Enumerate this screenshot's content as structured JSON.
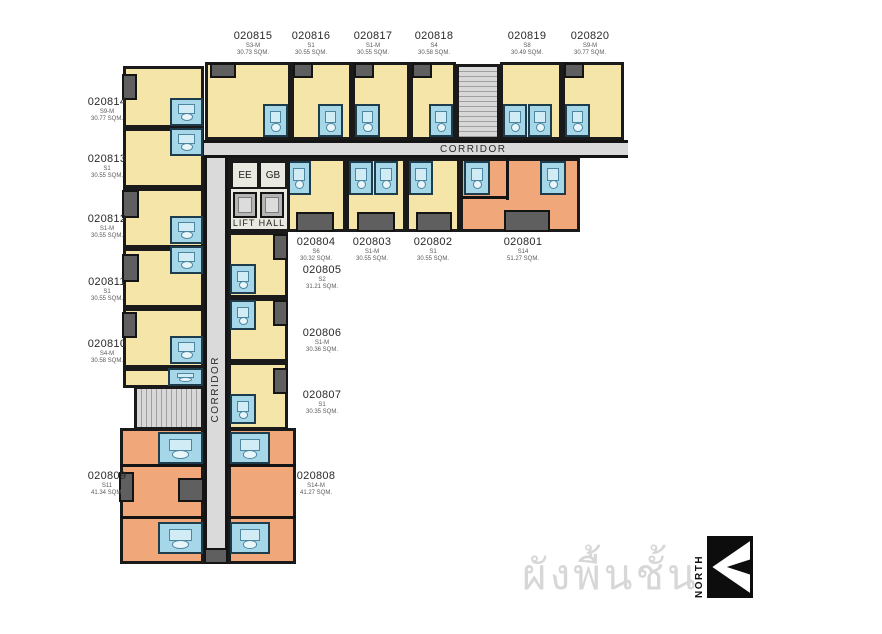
{
  "caption": {
    "text": "ผังพื้นชั้น 8"
  },
  "north_badge": {
    "label": "NORTH"
  },
  "corridors": {
    "top_label": "CORRIDOR",
    "left_label": "CORRIDOR"
  },
  "lift_hall": {
    "label": "LIFT HALL",
    "room_ee": "EE",
    "room_gb": "GB"
  },
  "units": [
    {
      "id": "020801",
      "type": "S14",
      "area": "51.27 SQM."
    },
    {
      "id": "020802",
      "type": "S1",
      "area": "30.55 SQM."
    },
    {
      "id": "020803",
      "type": "S1-M",
      "area": "30.55 SQM."
    },
    {
      "id": "020804",
      "type": "S6",
      "area": "30.32 SQM."
    },
    {
      "id": "020805",
      "type": "S2",
      "area": "31.21 SQM."
    },
    {
      "id": "020806",
      "type": "S1-M",
      "area": "30.36 SQM."
    },
    {
      "id": "020807",
      "type": "S1",
      "area": "30.35 SQM."
    },
    {
      "id": "020808",
      "type": "S14-M",
      "area": "41.27 SQM."
    },
    {
      "id": "020809",
      "type": "S11",
      "area": "41.34 SQM."
    },
    {
      "id": "020810",
      "type": "S4-M",
      "area": "30.58 SQM."
    },
    {
      "id": "020811",
      "type": "S1",
      "area": "30.55 SQM."
    },
    {
      "id": "020812",
      "type": "S1-M",
      "area": "30.55 SQM."
    },
    {
      "id": "020813",
      "type": "S1",
      "area": "30.55 SQM."
    },
    {
      "id": "020814",
      "type": "S9-M",
      "area": "30.77 SQM."
    },
    {
      "id": "020815",
      "type": "S3-M",
      "area": "30.73 SQM."
    },
    {
      "id": "020816",
      "type": "S1",
      "area": "30.55 SQM."
    },
    {
      "id": "020817",
      "type": "S1-M",
      "area": "30.55 SQM."
    },
    {
      "id": "020818",
      "type": "S4",
      "area": "30.58 SQM."
    },
    {
      "id": "020819",
      "type": "S8",
      "area": "30.49 SQM."
    },
    {
      "id": "020820",
      "type": "S9-M",
      "area": "30.77 SQM."
    }
  ]
}
